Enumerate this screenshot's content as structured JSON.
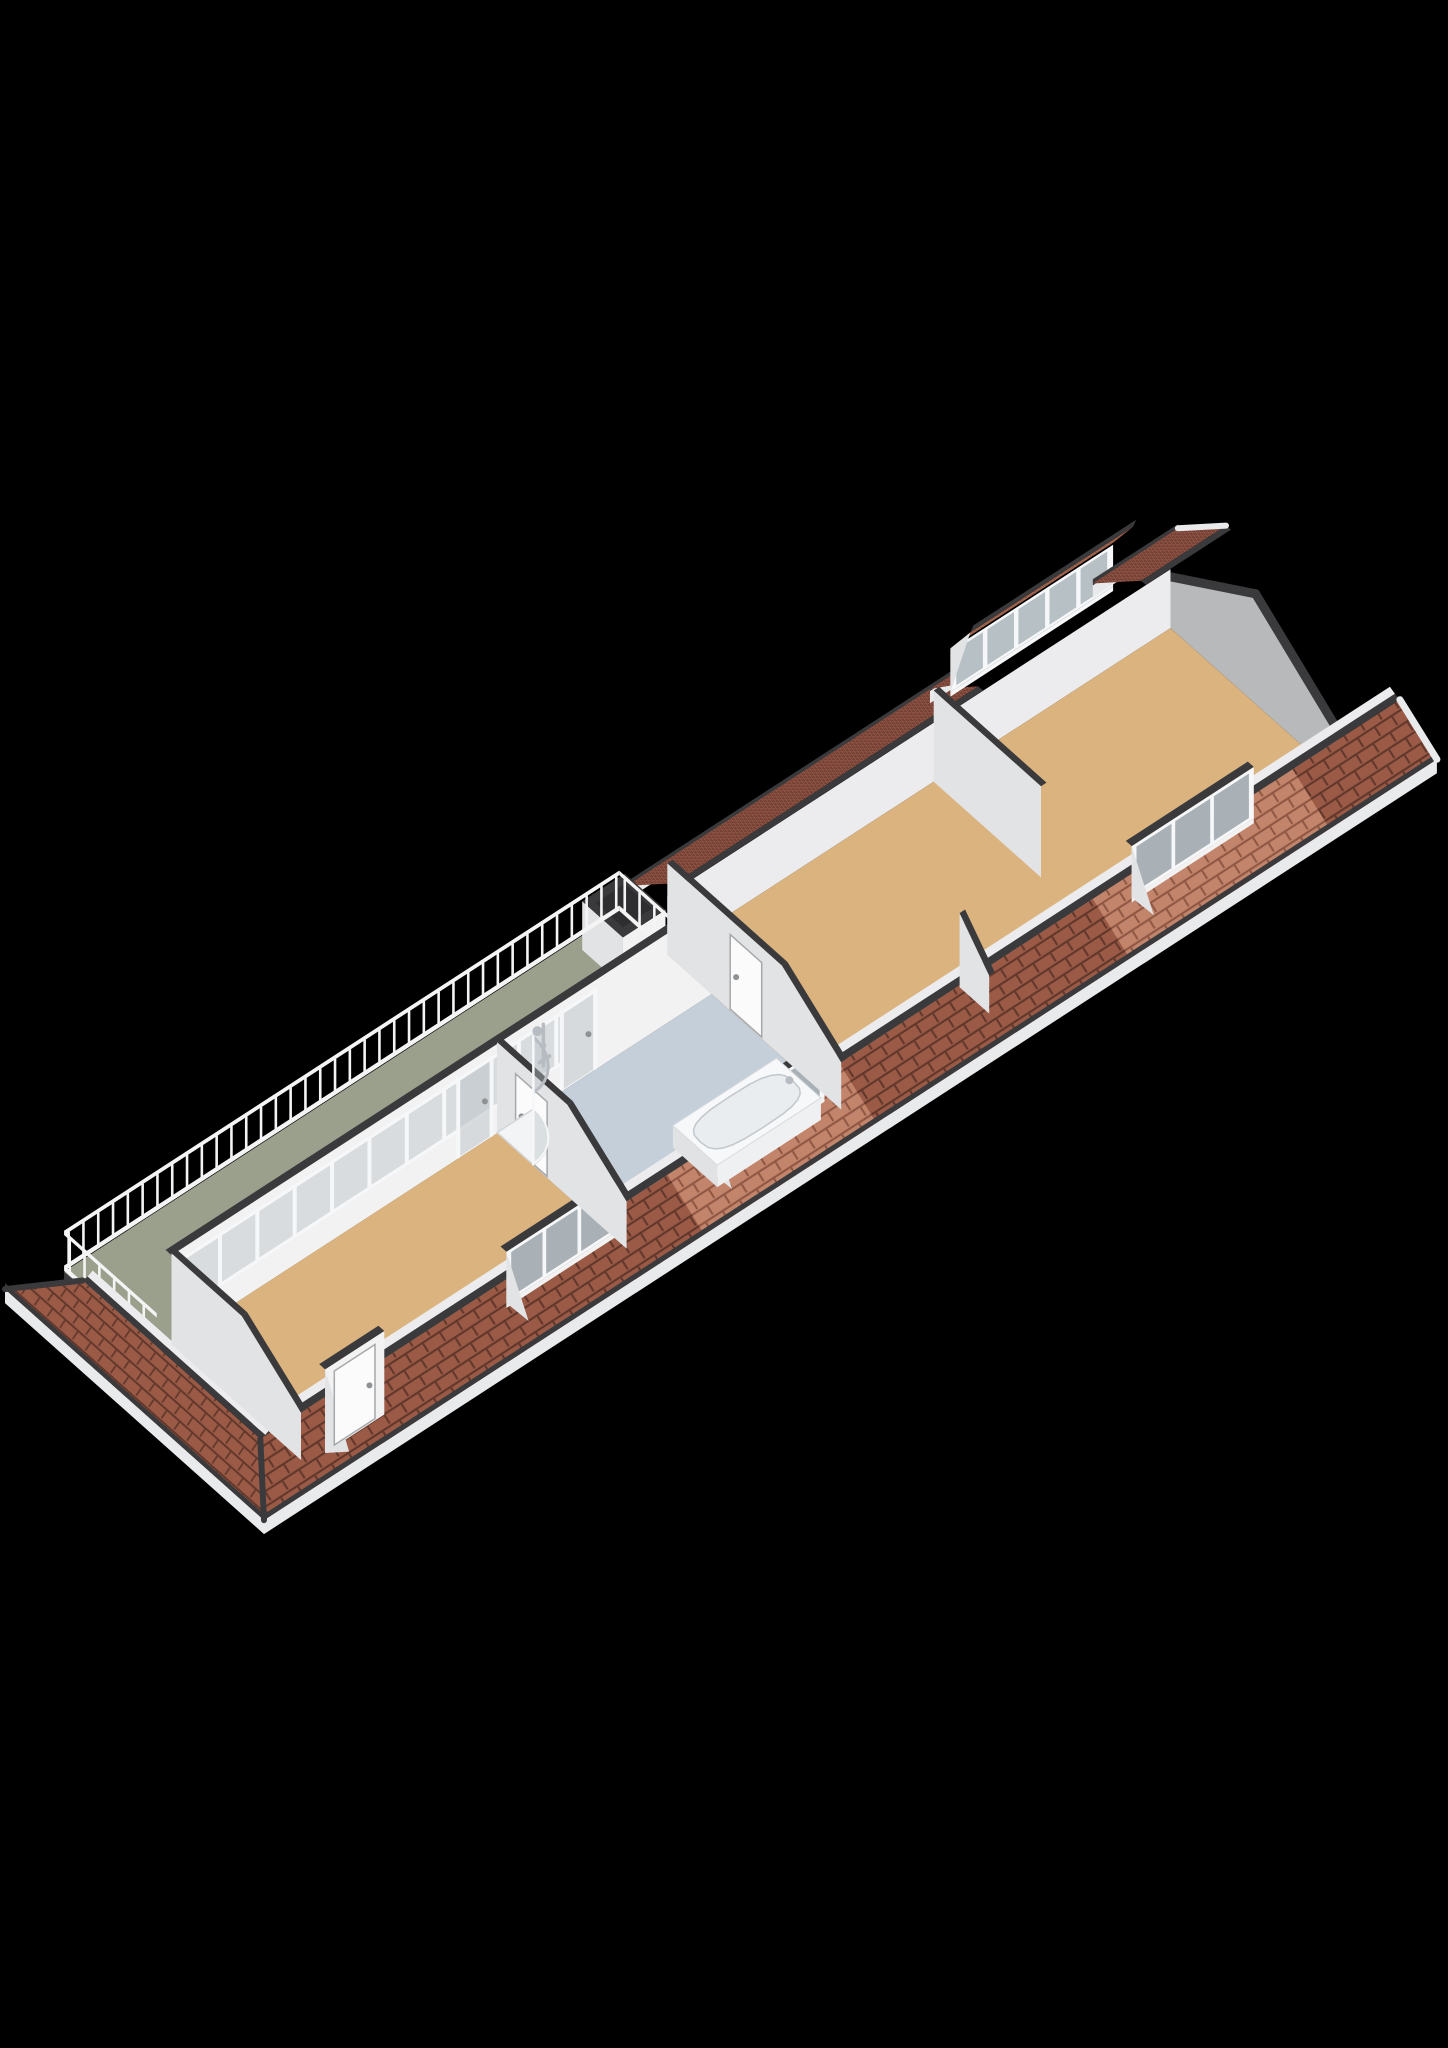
{
  "meta": {
    "view": "isometric-3d-floorplan",
    "storey": "attic-floor-with-roof-terrace"
  },
  "colors": {
    "background": "#000000",
    "tile_front": "#9a5a46",
    "tile_front_line": "#61372b",
    "tile_light": "#c2856b",
    "tile_light_line": "#8f5743",
    "tile_back": "#8e5242",
    "tile_back_line": "#5c332a",
    "tile_shed": "#a96950",
    "tile_shed_line": "#6f4034",
    "trim_dark": "#3a3a3c",
    "terrace_fascia": "#424244",
    "fascia_white": "#e9eaec",
    "wall_front": "#f2f2f3",
    "wall_side": "#e2e3e5",
    "knee_white": "#ececee",
    "gable_gray": "#b7b9bb",
    "floor_wood": "#dbb37e",
    "floor_bath": "#c5cfd9",
    "floor_terrace": "#9aa08c",
    "railing": "#f4f4f5",
    "glass": "#b9c2c6",
    "glass_frame": "#f6f7f8",
    "window_pane": "#a9b1b6",
    "shed_pane": "#b7c0c5",
    "chrome": "#b6bcc2",
    "door_white": "#fbfbfc",
    "door_frame": "#a6a8aa",
    "handle_gray": "#8f9194",
    "tub_white": "#f7f8f9",
    "tub_side": "#e0e2e4",
    "tub_front": "#eef0f1",
    "basin": "#e9edf0",
    "basin_line": "#c2c7cc",
    "shaft_top": "#2e2e30"
  },
  "scene": {
    "building": {
      "a_end": 31.7,
      "hip_cut_a": 0.9,
      "front": {
        "b_eave": 7.0,
        "z_eave": 0.55,
        "b_top": 6.0,
        "z_top": 1.25
      },
      "back": {
        "b_top": 1.3,
        "z_top": 1.75
      }
    },
    "terrace": {
      "a0": 1.6,
      "a1": 16.6,
      "b0": 0.0,
      "b1": 2.5,
      "shaft": {
        "a0": 15.35,
        "a1": 16.5,
        "b0": 0.25,
        "b1": 1.35,
        "h": 1.28
      }
    },
    "railing": {
      "height": 1.08,
      "post_gap": 0.4
    },
    "window_wall": {
      "b": 2.5,
      "a0": 2.0,
      "a1": 16.6,
      "h": 2.35,
      "sill": 0.75,
      "head": 2.05,
      "glass_a0": 2.3,
      "glass_a1": 12.5,
      "mullion_gap": 1.01,
      "doors": [
        {
          "a0": 9.75,
          "a1": 10.65
        },
        {
          "a0": 12.55,
          "a1": 13.45
        }
      ]
    },
    "rooms": [
      {
        "id": "floor-bedroom-left",
        "a0": 2.0,
        "a1": 10.8,
        "b0": 2.5,
        "b1": 6.0,
        "floor": "wood"
      },
      {
        "id": "floor-bathroom",
        "a0": 10.8,
        "a1": 16.6,
        "b0": 2.5,
        "b1": 6.0,
        "floor": "bath"
      },
      {
        "id": "floor-living-right",
        "a0": 16.6,
        "a1": 30.2,
        "b0": 1.3,
        "b1": 6.0,
        "floor": "wood",
        "knee": true
      }
    ],
    "walls": [
      {
        "id": "wall-stub-back",
        "a": 23.8,
        "b0": 1.3,
        "b1": 4.2,
        "flat": true
      },
      {
        "id": "wall-stub-front",
        "a": 20.6,
        "b0": 5.2,
        "b1": 6.0,
        "front_stub": true
      },
      {
        "id": "wall-living-left",
        "a": 16.6,
        "b0": 1.3,
        "b1": 6.0,
        "door": {
          "b0": 3.0,
          "b1": 3.85
        }
      },
      {
        "id": "wall-bathroom-left",
        "a": 10.8,
        "b0": 2.5,
        "b1": 6.0,
        "door": {
          "b0": 3.0,
          "b1": 3.85
        }
      },
      {
        "id": "wall-left-end",
        "a": 2.0,
        "b0": 2.5,
        "b1": 6.0
      }
    ],
    "gable": {
      "a": 30.2,
      "profile": [
        [
          1.3,
          0
        ],
        [
          6.0,
          0
        ],
        [
          6.0,
          1.1
        ],
        [
          3.6,
          2.9
        ],
        [
          1.3,
          1.35
        ]
      ]
    },
    "front_dormers": {
      "face_b": 6.15,
      "sill": 0.85,
      "head": 2.2,
      "items": [
        {
          "id": "dormer-roof-door",
          "a0": 2.5,
          "a1": 4.1,
          "door": true
        },
        {
          "id": "dormer-bedroom-left",
          "a0": 7.4,
          "a1": 10.4,
          "panes": 3
        },
        {
          "id": "dormer-bathroom",
          "a0": 12.9,
          "a1": 16.0,
          "panes": 3
        },
        {
          "id": "dormer-living",
          "a0": 24.3,
          "a1": 27.6,
          "panes": 3
        }
      ]
    },
    "shed_dormer": {
      "a0": 25.0,
      "a1": 29.4,
      "b": 0.55,
      "sill": 0.95,
      "head": 2.05,
      "panes": 5
    },
    "light_patches": [
      [
        11.9,
        16.55
      ],
      [
        23.4,
        28.8
      ]
    ],
    "bathroom": {
      "shower": {
        "ca": 10.8,
        "cb": 2.5,
        "r": 0.98,
        "h": 1.92,
        "col_a": 12.05
      },
      "tub": {
        "a0": 13.3,
        "a1": 16.1,
        "b0": 4.75,
        "b1": 5.95,
        "h": 0.58
      }
    }
  }
}
